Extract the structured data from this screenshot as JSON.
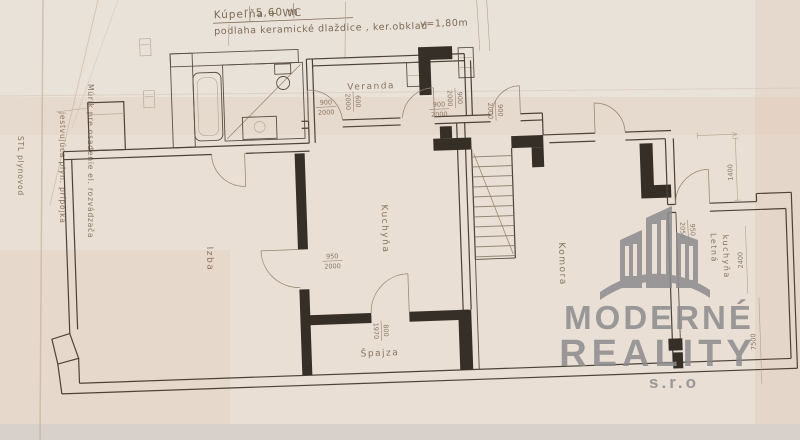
{
  "header": {
    "room_label": "Kúpeľňa + WC",
    "area": "5,60 m",
    "materials": "podlaha keramické dlaždice , ker.obklad",
    "height": "v=1,80m"
  },
  "rooms": {
    "veranda": "Veranda",
    "izba": "Izba",
    "kuchyna": "Kuchyňa",
    "spajza": "Špajza",
    "komora": "Komora",
    "letna_line1": "Letná",
    "letna_line2": "kuchyňa"
  },
  "annotations": {
    "murik": "Múrik pre osadenie el. rozvádzača",
    "plyn_pripojka": "jestvujúca plyn. prípojka",
    "stl": "STL plynovod"
  },
  "dimensions": {
    "door_veranda_left": {
      "w": "900",
      "h": "2000"
    },
    "door_veranda_side": {
      "w": "600",
      "h": "2000"
    },
    "door_veranda_right": {
      "w": "900",
      "h": "2000"
    },
    "door_izba": {
      "w": "950",
      "h": "2000"
    },
    "door_spajza": {
      "w": "800",
      "h": "1970"
    },
    "door_stair_left": {
      "w": "900",
      "h": "2000"
    },
    "door_stair": {
      "w": "900",
      "h": "2000"
    },
    "door_letna": {
      "w": "950",
      "h": "2050"
    },
    "len_2400": "2400",
    "len_1400": "1400",
    "len_7500": "7500"
  },
  "watermark": {
    "line1": "MODERNÉ",
    "line2": "REALITY",
    "line3": "s.r.o",
    "color": "#8c8b8d"
  },
  "colors": {
    "paper": "#e9dfd4",
    "ink": "#4c4238",
    "faded_ink": "#8b7662",
    "black_wall": "#352f28"
  }
}
